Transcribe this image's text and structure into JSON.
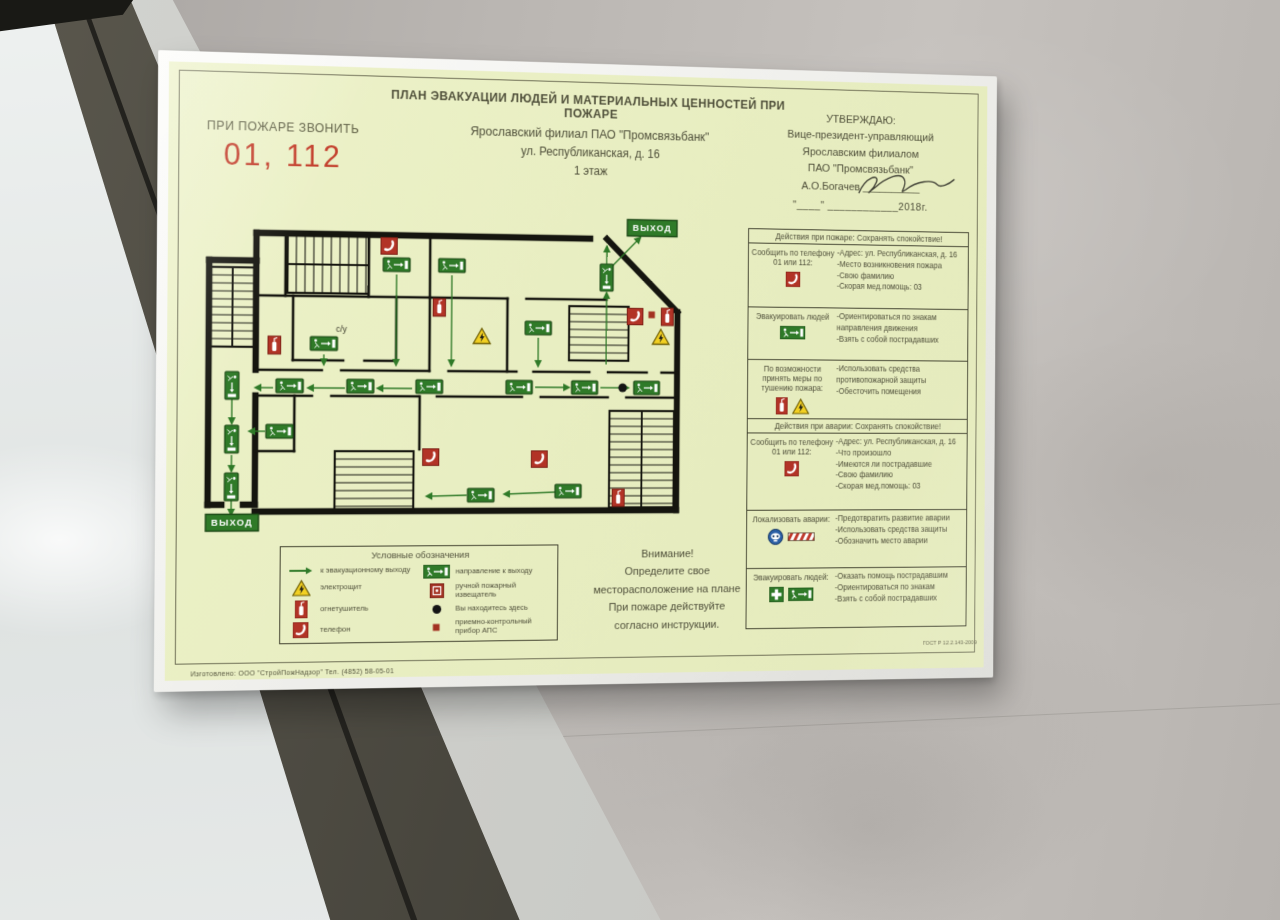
{
  "colors": {
    "sheet": "#e9eec6",
    "accent_red": "#c23b28",
    "sign_green": "#2f7a28",
    "icon_red": "#b23326",
    "warning_yellow": "#f2d023",
    "wall_line": "#15150f"
  },
  "header": {
    "title": "ПЛАН ЭВАКУАЦИИ ЛЮДЕЙ И МАТЕРИАЛЬНЫХ ЦЕННОСТЕЙ ПРИ ПОЖАРЕ",
    "organization": "Ярославский филиал ПАО \"Промсвязьбанк\"",
    "address": "ул. Республиканская, д. 16",
    "floor": "1 этаж"
  },
  "emergency_call": {
    "label": "ПРИ ПОЖАРЕ ЗВОНИТЬ",
    "numbers": "01, 112"
  },
  "approval": {
    "lines": [
      "УТВЕРЖДАЮ:",
      "Вице-президент-управляющий",
      "Ярославским филиалом",
      "ПАО \"Промсвязьбанк\""
    ],
    "name_line": "А.О.Богачев",
    "date_line": "\"____\"  ____________2018г."
  },
  "floor_plan": {
    "exit_label_top": "ВЫХОД",
    "exit_label_bottom": "ВЫХОД",
    "room_label": "с/у",
    "walls_outer": [
      [
        70,
        22,
        420,
        22
      ],
      [
        438,
        22,
        515,
        97
      ],
      [
        515,
        97,
        515,
        303
      ],
      [
        70,
        303,
        515,
        303
      ],
      [
        70,
        22,
        70,
        50
      ],
      [
        22,
        50,
        70,
        50
      ],
      [
        22,
        50,
        22,
        296
      ],
      [
        22,
        296,
        36,
        296
      ],
      [
        58,
        296,
        70,
        296
      ],
      [
        70,
        50,
        70,
        160
      ],
      [
        70,
        186,
        70,
        296
      ]
    ],
    "walls_inner": [
      [
        100,
        22,
        100,
        85
      ],
      [
        186,
        22,
        186,
        85
      ],
      [
        70,
        85,
        250,
        85
      ],
      [
        250,
        22,
        250,
        160
      ],
      [
        250,
        85,
        332,
        85
      ],
      [
        352,
        85,
        438,
        85
      ],
      [
        332,
        85,
        332,
        160
      ],
      [
        108,
        85,
        108,
        150
      ],
      [
        215,
        85,
        215,
        150
      ],
      [
        108,
        150,
        160,
        150
      ],
      [
        182,
        150,
        215,
        150
      ],
      [
        70,
        160,
        138,
        160
      ],
      [
        158,
        160,
        250,
        160
      ],
      [
        270,
        160,
        342,
        160
      ],
      [
        360,
        160,
        420,
        160
      ],
      [
        440,
        160,
        482,
        160
      ],
      [
        498,
        160,
        515,
        160
      ],
      [
        70,
        186,
        128,
        186
      ],
      [
        148,
        186,
        238,
        186
      ],
      [
        258,
        186,
        348,
        186
      ],
      [
        368,
        186,
        440,
        186
      ],
      [
        460,
        186,
        515,
        186
      ],
      [
        110,
        186,
        110,
        242
      ],
      [
        70,
        242,
        110,
        242
      ],
      [
        240,
        186,
        240,
        240
      ]
    ],
    "stairs": [
      {
        "x": 24,
        "y": 57,
        "w": 44,
        "h": 80,
        "dir": "h",
        "divider": "v"
      },
      {
        "x": 102,
        "y": 24,
        "w": 84,
        "h": 58,
        "dir": "v",
        "divider": "h"
      },
      {
        "x": 398,
        "y": 92,
        "w": 64,
        "h": 56,
        "dir": "h",
        "divider": null
      },
      {
        "x": 442,
        "y": 200,
        "w": 70,
        "h": 100,
        "dir": "h",
        "divider": "v"
      },
      {
        "x": 152,
        "y": 242,
        "w": 82,
        "h": 60,
        "dir": "h",
        "divider": null
      }
    ],
    "signs": [
      [
        215,
        52,
        0
      ],
      [
        273,
        52,
        0
      ],
      [
        438,
        62,
        90
      ],
      [
        365,
        115,
        0
      ],
      [
        140,
        133,
        0
      ],
      [
        105,
        176,
        0
      ],
      [
        178,
        176,
        0
      ],
      [
        250,
        176,
        0
      ],
      [
        345,
        176,
        0
      ],
      [
        415,
        176,
        0
      ],
      [
        482,
        176,
        0
      ],
      [
        95,
        222,
        0
      ],
      [
        46,
        176,
        90
      ],
      [
        46,
        230,
        90
      ],
      [
        46,
        278,
        90
      ],
      [
        305,
        287,
        0
      ],
      [
        398,
        283,
        0
      ]
    ],
    "arrows": [
      [
        215,
        62,
        215,
        154
      ],
      [
        273,
        62,
        273,
        154
      ],
      [
        365,
        125,
        365,
        154
      ],
      [
        140,
        144,
        140,
        154
      ],
      [
        438,
        152,
        438,
        78
      ],
      [
        438,
        52,
        438,
        30
      ],
      [
        444,
        50,
        474,
        20
      ],
      [
        232,
        178,
        196,
        178
      ],
      [
        162,
        178,
        124,
        178
      ],
      [
        88,
        178,
        70,
        178
      ],
      [
        362,
        176,
        398,
        176
      ],
      [
        432,
        176,
        462,
        176
      ],
      [
        80,
        222,
        64,
        222
      ],
      [
        46,
        190,
        46,
        214
      ],
      [
        46,
        246,
        46,
        262
      ],
      [
        46,
        292,
        46,
        306
      ],
      [
        384,
        284,
        330,
        286
      ],
      [
        290,
        287,
        248,
        288
      ]
    ],
    "icons": [
      [
        "phone",
        207,
        33
      ],
      [
        "phone",
        469,
        102
      ],
      [
        "phone",
        252,
        248
      ],
      [
        "phone",
        367,
        250
      ],
      [
        "ext",
        260,
        95
      ],
      [
        "ext",
        89,
        135
      ],
      [
        "ext",
        504,
        102
      ],
      [
        "ext",
        452,
        290
      ],
      [
        "tri",
        305,
        125
      ],
      [
        "tri",
        497,
        124
      ],
      [
        "aps",
        487,
        100
      ]
    ],
    "you_are_here": [
      456,
      176
    ],
    "exit_top_pos": [
      487,
      10
    ],
    "exit_bottom_pos": [
      47,
      314
    ],
    "room_label_pos": [
      158,
      121
    ]
  },
  "instructions": {
    "sections": [
      {
        "header": "Действия при пожаре: Сохранять спокойствие!",
        "rows": [
          {
            "h": 66,
            "left": "Сообщить по телефону 01 или 112:",
            "icons": [
              "phone"
            ],
            "right": [
              "-Адрес: ул. Республиканская, д. 16",
              "-Место возникновения пожара",
              "-Свою фамилию",
              "-Скорая мед.помощь: 03"
            ]
          },
          {
            "h": 54,
            "left": "Эвакуировать людей",
            "icons": [
              "exitsign"
            ],
            "right": [
              "-Ориентироваться по знакам направления движения",
              "-Взять с собой пострадавших"
            ]
          },
          {
            "h": 58,
            "left": "По возможности принять меры по тушению пожара:",
            "icons": [
              "ext",
              "tri"
            ],
            "right": [
              "-Использовать средства противопожарной защиты",
              "-Обесточить помещения"
            ]
          }
        ]
      },
      {
        "header": "Действия при аварии: Сохранять спокойствие!",
        "rows": [
          {
            "h": 80,
            "left": "Сообщить по телефону 01 или 112:",
            "icons": [
              "phone"
            ],
            "right": [
              "-Адрес: ул. Республиканская, д. 16",
              "-Что произошло",
              "-Имеются ли пострадавшие",
              "-Свою фамилию",
              "-Скорая мед.помощь: 03"
            ]
          },
          {
            "h": 60,
            "left": "Локализовать аварии:",
            "icons": [
              "mask",
              "barrier"
            ],
            "right": [
              "-Предотвратить развитие аварии",
              "-Использовать средства защиты",
              "-Обозначить место аварии"
            ]
          },
          {
            "h": 62,
            "left": "Эвакуировать людей:",
            "icons": [
              "cross",
              "exitsign"
            ],
            "right": [
              "-Оказать помощь пострадавшим",
              "-Ориентироваться по знакам",
              "-Взять с собой пострадавших"
            ]
          }
        ]
      }
    ]
  },
  "legend": {
    "title": "Условные обозначения",
    "left": [
      {
        "icon": "arrow",
        "label": "к эвакуационному выходу"
      },
      {
        "icon": "tri",
        "label": "электрощит"
      },
      {
        "icon": "ext",
        "label": "огнетушитель"
      },
      {
        "icon": "phone",
        "label": "телефон"
      }
    ],
    "right": [
      {
        "icon": "exitsign",
        "label": "направление к выходу"
      },
      {
        "icon": "callpoint",
        "label": "ручной пожарный извещатель"
      },
      {
        "icon": "dot",
        "label": "Вы находитесь здесь"
      },
      {
        "icon": "aps",
        "label": "приемно-контрольный прибор АПС"
      }
    ]
  },
  "attention": {
    "lines": [
      "Внимание!",
      "Определите свое",
      "месторасположение на плане",
      "При пожаре действуйте",
      "согласно инструкции."
    ]
  },
  "footer": {
    "maker": "Изготовлено: ООО \"СтройПожНадзор\"  Тел. (4852) 58-05-01",
    "gost": "ГОСТ Р 12.2.143-2009"
  }
}
